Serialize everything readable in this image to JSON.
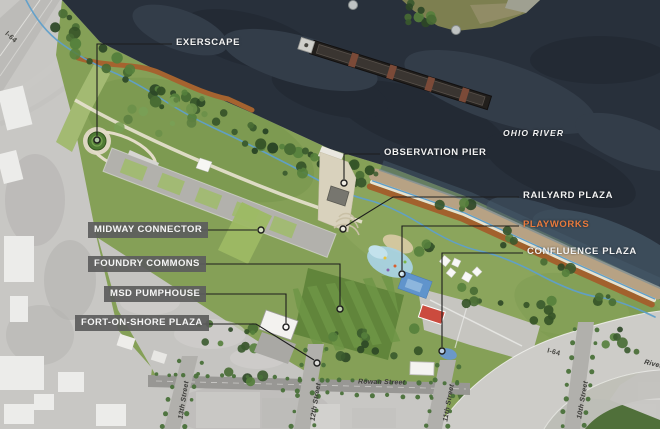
{
  "plan_labels": {
    "exerscape": "EXERSCAPE",
    "observation_pier": "OBSERVATION PIER",
    "railyard_plaza": "RAILYARD PLAZA",
    "playworks": "PLAYWORKS",
    "confluence_plaza": "CONFLUENCE PLAZA",
    "midway_connector": "MIDWAY CONNECTOR",
    "foundry_commons": "FOUNDRY COMMONS",
    "msd_pumphouse": "MSD PUMPHOUSE",
    "fort_on_shore_plaza": "FORT-ON-SHORE PLAZA"
  },
  "geo_labels": {
    "river": "OHIO RIVER",
    "interstate_northwest": "I-64",
    "interstate_southeast": "I-64",
    "rowan_street": "Rowan Street",
    "street_13th": "13th Street",
    "street_12th": "12th Street",
    "street_11th": "11th Street",
    "street_10th": "10th Street",
    "river_road_partial": "River"
  },
  "colors": {
    "highlight_orange": "#E87A3D",
    "label_text": "#F2F2F2",
    "label_box_background": "#5C5C5C",
    "river_water": "#28303B",
    "park_green": "#85A057",
    "beach_sand": "#B7A284",
    "trail_blue": "#5F9FCA",
    "trail_orange": "#A2612D"
  }
}
